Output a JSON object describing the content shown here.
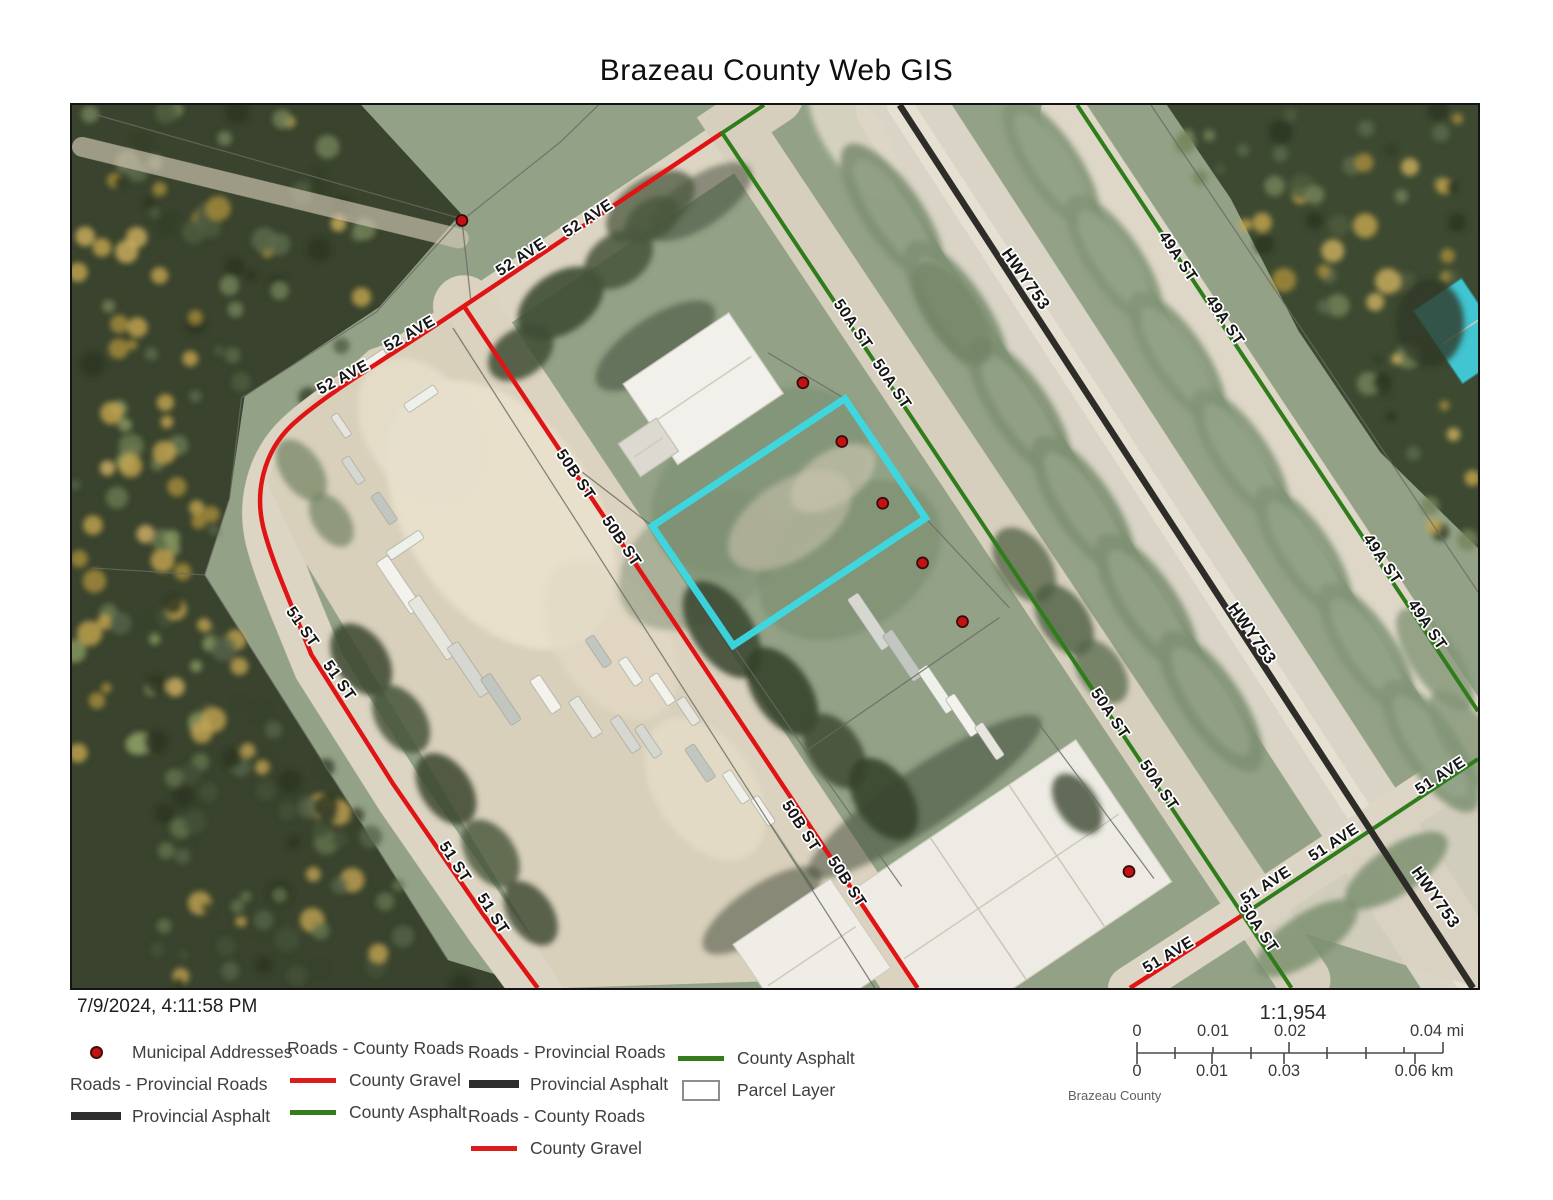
{
  "title": "Brazeau County Web GIS",
  "timestamp": "7/9/2024, 4:11:58 PM",
  "colors": {
    "county_gravel": "#e01414",
    "county_asphalt": "#2f7d1a",
    "provincial_asphalt": "#2e2c28",
    "parcel_highlight": "#3bd9e4",
    "municipal_address": "#c41212"
  },
  "legend": {
    "columns": [
      {
        "items": [
          {
            "kind": "point",
            "label": "Municipal Addresses"
          },
          {
            "kind": "header",
            "label": "Roads - Provincial Roads"
          },
          {
            "kind": "line-black",
            "label": "Provincial Asphalt"
          }
        ]
      },
      {
        "items": [
          {
            "kind": "header",
            "label": "Roads - County Roads"
          },
          {
            "kind": "line-red",
            "label": "County Gravel"
          },
          {
            "kind": "line-green",
            "label": "County Asphalt"
          }
        ]
      },
      {
        "items": [
          {
            "kind": "header",
            "label": "Roads - Provincial Roads"
          },
          {
            "kind": "line-black",
            "label": "Provincial Asphalt"
          },
          {
            "kind": "header",
            "label": "Roads - County Roads"
          },
          {
            "kind": "line-red",
            "label": "County Gravel"
          }
        ]
      },
      {
        "items": [
          {
            "kind": "line-green",
            "label": "County Asphalt"
          },
          {
            "kind": "rect",
            "label": "Parcel Layer"
          }
        ]
      }
    ]
  },
  "scalebar": {
    "ratio": "1:1,954",
    "mi_labels": [
      "0",
      "0.01",
      "0.02",
      "0.04 mi"
    ],
    "km_labels": [
      "0",
      "0.01",
      "0.03",
      "0.06 km"
    ],
    "attribution": "Brazeau County"
  },
  "map": {
    "roads": [
      {
        "name": "52 Ave / 51 St",
        "kind": "county_gravel",
        "d": "M 722 131 L 463 305 C 395 352 325 392 290 425 C 262 452 253 492 262 528 C 270 560 288 600 310 655 L 392 785 L 483 917 L 537 990"
      },
      {
        "name": "50B St",
        "kind": "county_gravel",
        "d": "M 463 305 L 918 990"
      },
      {
        "name": "51 Ave gravel",
        "kind": "county_gravel",
        "d": "M 1131 990 L 1245 916"
      },
      {
        "name": "50A St",
        "kind": "county_asphalt",
        "d": "M 764 103 L 722 131 L 1293 990"
      },
      {
        "name": "49A St",
        "kind": "county_asphalt",
        "d": "M 1078 103 L 1480 712"
      },
      {
        "name": "51 Ave asphalt",
        "kind": "county_asphalt",
        "d": "M 1245 916 L 1480 760"
      },
      {
        "name": "Hwy 753",
        "kind": "provincial_asphalt",
        "d": "M 900 103 L 1475 990"
      }
    ],
    "road_labels": [
      {
        "t": "52 AVE",
        "x": 590,
        "y": 221,
        "r": -33
      },
      {
        "t": "52 AVE",
        "x": 523,
        "y": 260,
        "r": -33
      },
      {
        "t": "52 AVE",
        "x": 411,
        "y": 337,
        "r": -30
      },
      {
        "t": "52 AVE",
        "x": 344,
        "y": 381,
        "r": -28
      },
      {
        "t": "50B ST",
        "x": 571,
        "y": 477,
        "r": 56
      },
      {
        "t": "50B ST",
        "x": 617,
        "y": 544,
        "r": 56
      },
      {
        "t": "50B ST",
        "x": 797,
        "y": 830,
        "r": 57
      },
      {
        "t": "50B ST",
        "x": 843,
        "y": 886,
        "r": 57
      },
      {
        "t": "51 ST",
        "x": 297,
        "y": 630,
        "r": 55
      },
      {
        "t": "51 ST",
        "x": 334,
        "y": 684,
        "r": 55
      },
      {
        "t": "51 ST",
        "x": 450,
        "y": 866,
        "r": 57
      },
      {
        "t": "51 ST",
        "x": 488,
        "y": 918,
        "r": 57
      },
      {
        "t": "50A ST",
        "x": 849,
        "y": 326,
        "r": 56
      },
      {
        "t": "50A ST",
        "x": 888,
        "y": 386,
        "r": 56
      },
      {
        "t": "50A ST",
        "x": 1107,
        "y": 717,
        "r": 56
      },
      {
        "t": "50A ST",
        "x": 1156,
        "y": 789,
        "r": 56
      },
      {
        "t": "50A ST",
        "x": 1256,
        "y": 932,
        "r": 56
      },
      {
        "t": "49A ST",
        "x": 1175,
        "y": 258,
        "r": 56
      },
      {
        "t": "49A ST",
        "x": 1222,
        "y": 322,
        "r": 56
      },
      {
        "t": "49A ST",
        "x": 1380,
        "y": 562,
        "r": 56
      },
      {
        "t": "49A ST",
        "x": 1425,
        "y": 628,
        "r": 56
      },
      {
        "t": "HWY753",
        "x": 1022,
        "y": 281,
        "r": 55
      },
      {
        "t": "HWY753",
        "x": 1249,
        "y": 637,
        "r": 55
      },
      {
        "t": "HWY753",
        "x": 1433,
        "y": 902,
        "r": 55
      },
      {
        "t": "51 AVE",
        "x": 1270,
        "y": 891,
        "r": -33
      },
      {
        "t": "51 AVE",
        "x": 1338,
        "y": 848,
        "r": -33
      },
      {
        "t": "51 AVE",
        "x": 1445,
        "y": 781,
        "r": -33
      },
      {
        "t": "51 AVE",
        "x": 1172,
        "y": 961,
        "r": -31
      }
    ],
    "address_dots": [
      [
        461,
        219
      ],
      [
        803,
        382
      ],
      [
        842,
        441
      ],
      [
        883,
        503
      ],
      [
        923,
        563
      ],
      [
        963,
        622
      ],
      [
        1130,
        873
      ]
    ],
    "highlight_parcel": [
      [
        845,
        398
      ],
      [
        926,
        518
      ],
      [
        733,
        646
      ],
      [
        652,
        526
      ]
    ]
  }
}
